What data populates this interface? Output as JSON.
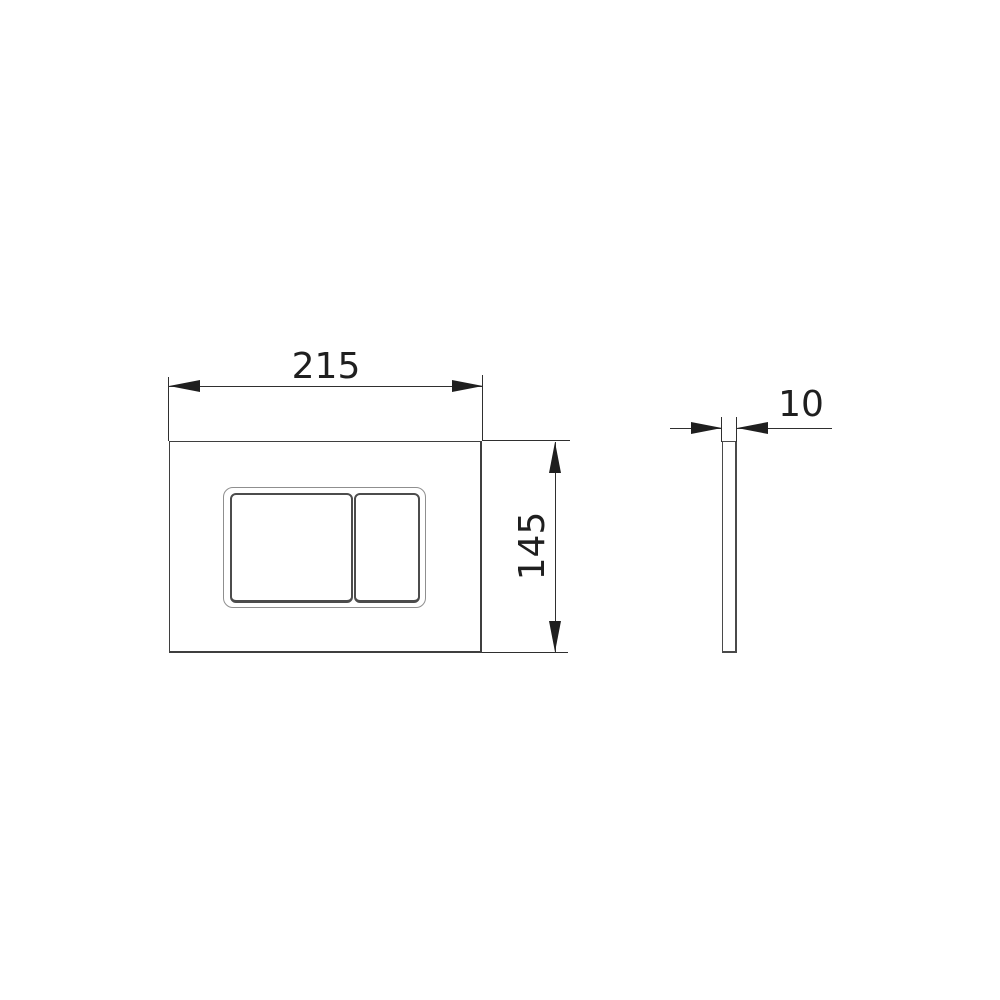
{
  "drawing": {
    "type": "technical-dimension-drawing",
    "subject": "flush-plate",
    "background_color": "#ffffff",
    "line_color": "#3f3f3f",
    "dimension_color": "#1f1f1f",
    "front_view": {
      "width_label": "215",
      "height_label": "145"
    },
    "side_view": {
      "thickness_label": "10"
    }
  }
}
